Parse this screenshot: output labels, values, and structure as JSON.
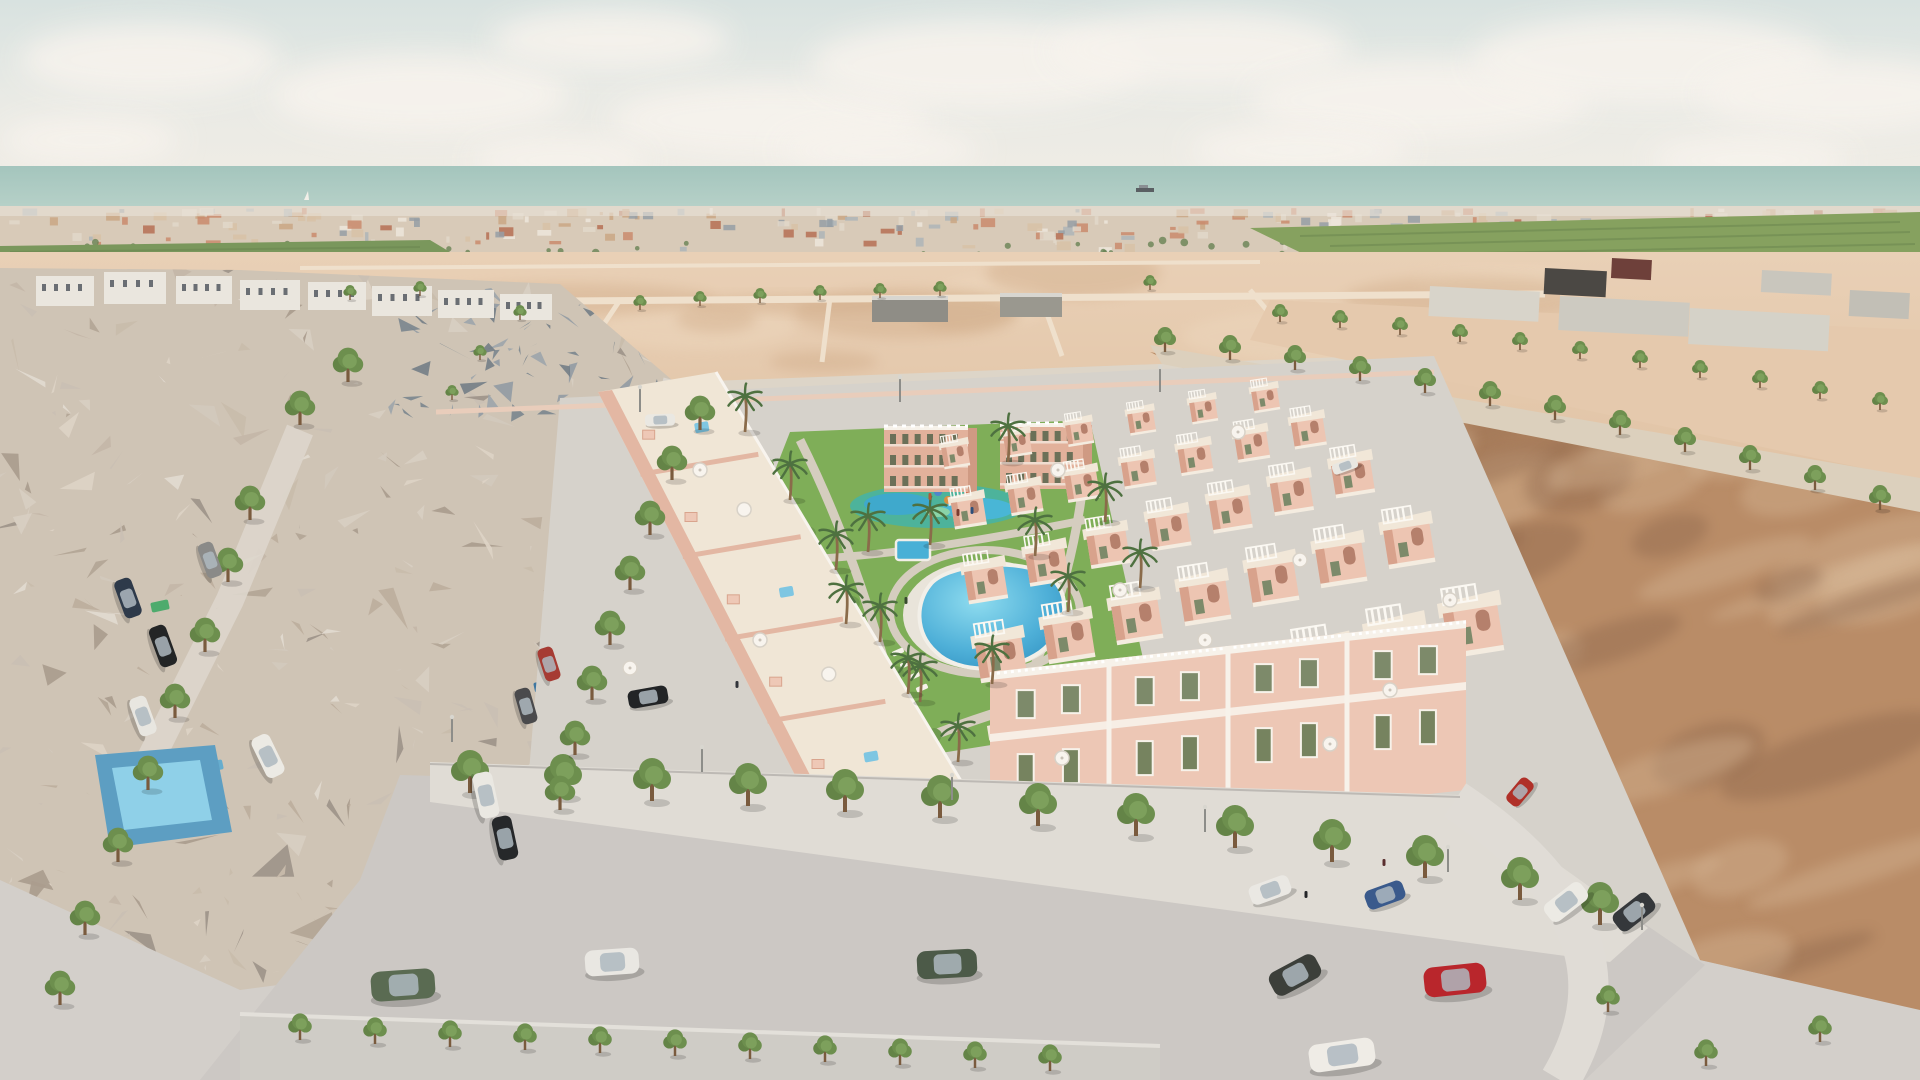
{
  "meta": {
    "description": "Aerial 3D architectural render of a new pink townhouse development with central pool park, between an existing low-poly neighborhood, desert plots and the sea on the horizon",
    "render_type": "architectural-visualization",
    "visible_text": ""
  },
  "colors": {
    "sky_top": "#d8e2e0",
    "sky_low": "#efece5",
    "cloud": "#f7f3ed",
    "sea_top": "#a4c5bd",
    "sea_low": "#bad3ca",
    "horizon_base": "#d8cab8",
    "orchard": "#7a975c",
    "field_green": "#86a15f",
    "sand_light": "#e9d0b6",
    "sand_dark": "#d9b795",
    "dirt": "#b98c67",
    "dirt_dark": "#8a6448",
    "dirt_light": "#d7b897",
    "mesh_base": "#cfc4b5",
    "pavement": "#d6d2cb",
    "street": "#ccc8c4",
    "sidewalk": "#e0dcd5",
    "lawn": "#7fae58",
    "path": "#d4ccbe",
    "pool_light": "#7fd2e8",
    "pool_deep": "#2f8fc0",
    "splash_green": "#4db39b",
    "house_wall": "#edc7b5",
    "house_shadow": "#d9a48d",
    "roof_cream": "#f0e6d6",
    "white_trim": "#f7f2ea",
    "apt_wall": "#e2b19b",
    "window_green": "#7d8a6a",
    "tree_green": "#6d8f4e",
    "palm_green": "#4e7140",
    "trunk": "#7a5b3e"
  },
  "scene": {
    "clouds": [
      [
        150,
        60,
        130,
        36
      ],
      [
        420,
        95,
        150,
        40
      ],
      [
        610,
        40,
        120,
        30
      ],
      [
        770,
        120,
        160,
        36
      ],
      [
        980,
        65,
        170,
        44
      ],
      [
        1200,
        50,
        150,
        38
      ],
      [
        1420,
        100,
        170,
        40
      ],
      [
        1650,
        60,
        180,
        44
      ],
      [
        1840,
        95,
        140,
        36
      ],
      [
        90,
        140,
        90,
        24
      ],
      [
        1300,
        150,
        110,
        26
      ],
      [
        560,
        160,
        90,
        22
      ],
      [
        1750,
        160,
        100,
        24
      ],
      [
        880,
        150,
        100,
        22
      ]
    ],
    "boats": {
      "sailboat": [
        306,
        196
      ],
      "cargo": [
        1143,
        190
      ]
    },
    "horizon": {
      "seed": 7,
      "count": 240,
      "palette": [
        "#b3664a",
        "#c88465",
        "#e3d9cb",
        "#f0e9df",
        "#a9b3b9",
        "#8f9aa3",
        "#d8c1a4",
        "#c9a37f"
      ]
    },
    "mesh": {
      "seed": 13,
      "count": 260,
      "palette": [
        "#ddd3c6",
        "#c9bcab",
        "#bdae9d",
        "#b3a596",
        "#d3c9bd",
        "#c4b6a8",
        "#aa9c8e",
        "#e2dad0",
        "#9e948a",
        "#cabfb4",
        "#d8cec2"
      ],
      "dark_count": 70,
      "dark_palette": [
        "#8e99a2",
        "#76828c",
        "#9aa3aa",
        "#6e7a84"
      ]
    },
    "condos": [
      [
        36,
        276,
        58,
        30
      ],
      [
        104,
        272,
        62,
        32
      ],
      [
        176,
        276,
        56,
        28
      ],
      [
        240,
        280,
        60,
        30
      ],
      [
        308,
        282,
        58,
        28
      ],
      [
        372,
        286,
        60,
        30
      ],
      [
        438,
        290,
        56,
        28
      ],
      [
        500,
        294,
        52,
        26
      ]
    ],
    "mesh_pools": [
      [
        640,
        468,
        "#2e9e8f"
      ],
      [
        600,
        508,
        "#2e6f9e"
      ],
      [
        585,
        556,
        "#3b79a8"
      ],
      [
        568,
        602,
        "#2e6f9e"
      ],
      [
        556,
        642,
        "#35749f"
      ],
      [
        543,
        686,
        "#2e6f9e"
      ],
      [
        214,
        766,
        "#5aabd0"
      ],
      [
        160,
        606,
        "#3fa965"
      ]
    ],
    "warehouses": [
      [
        872,
        296,
        76,
        26,
        "#8f8d86"
      ],
      [
        1000,
        293,
        62,
        24,
        "#9a988f"
      ]
    ],
    "industrial": [
      [
        1430,
        286,
        110,
        30,
        "#d8d4ca"
      ],
      [
        1560,
        296,
        130,
        34,
        "#cdcac1"
      ],
      [
        1690,
        308,
        140,
        36,
        "#d5d2c8"
      ],
      [
        1545,
        268,
        62,
        26,
        "#4b4844"
      ],
      [
        1612,
        258,
        40,
        20,
        "#6e403a"
      ],
      [
        1762,
        270,
        70,
        22,
        "#c9c6bd"
      ],
      [
        1850,
        290,
        60,
        26,
        "#c2bfb6"
      ]
    ],
    "left_block": {
      "x1": 598,
      "y1": 392,
      "x2": 852,
      "y2": 886,
      "ox": 118,
      "oy": -20,
      "n": 6
    },
    "apartments": [
      {
        "x": 884,
        "y": 426,
        "w": 84,
        "h": 66
      },
      {
        "x": 1000,
        "y": 423,
        "w": 83,
        "h": 66
      }
    ],
    "right_rows": [
      {
        "x1": 955,
        "y1": 452,
        "x2": 1265,
        "y2": 396,
        "n": 6,
        "s": 0.5
      },
      {
        "x1": 968,
        "y1": 508,
        "x2": 1308,
        "y2": 428,
        "n": 7,
        "s": 0.62
      },
      {
        "x1": 985,
        "y1": 578,
        "x2": 1352,
        "y2": 472,
        "n": 7,
        "s": 0.76
      },
      {
        "x1": 1000,
        "y1": 652,
        "x2": 1408,
        "y2": 538,
        "n": 7,
        "s": 0.9
      },
      {
        "x1": 1022,
        "y1": 744,
        "x2": 1472,
        "y2": 622,
        "n": 7,
        "s": 1.06
      }
    ],
    "front_row": {
      "x1": 990,
      "y1": 672,
      "x2": 1466,
      "y2": 620,
      "h": 170,
      "n": 4
    },
    "planters": [
      [
        762,
        472
      ],
      [
        804,
        540
      ],
      [
        848,
        610
      ],
      [
        892,
        680
      ],
      [
        930,
        742
      ]
    ],
    "palms": [
      [
        745,
        432
      ],
      [
        790,
        500
      ],
      [
        836,
        570
      ],
      [
        880,
        642
      ],
      [
        920,
        702
      ],
      [
        958,
        762
      ],
      [
        868,
        552
      ],
      [
        1035,
        556
      ],
      [
        1068,
        612
      ],
      [
        992,
        684
      ],
      [
        908,
        694
      ],
      [
        846,
        624
      ],
      [
        1105,
        522
      ],
      [
        1140,
        588
      ],
      [
        1008,
        462
      ],
      [
        930,
        545
      ]
    ],
    "loungers": [
      [
        898,
        652
      ],
      [
        906,
        664
      ],
      [
        914,
        676
      ],
      [
        922,
        688
      ],
      [
        890,
        676
      ],
      [
        882,
        664
      ]
    ],
    "trees": {
      "street": [
        [
          470,
          793
        ],
        [
          563,
          797
        ],
        [
          652,
          801
        ],
        [
          748,
          806
        ],
        [
          845,
          812
        ],
        [
          940,
          818
        ],
        [
          1038,
          826
        ],
        [
          1136,
          836
        ],
        [
          1235,
          848
        ],
        [
          1332,
          862
        ],
        [
          1425,
          878
        ],
        [
          1520,
          900
        ],
        [
          1600,
          925
        ]
      ],
      "median": [
        [
          300,
          1040
        ],
        [
          375,
          1044
        ],
        [
          450,
          1047
        ],
        [
          525,
          1050
        ],
        [
          600,
          1053
        ],
        [
          675,
          1056
        ],
        [
          750,
          1059
        ],
        [
          825,
          1062
        ],
        [
          900,
          1065
        ],
        [
          975,
          1068
        ],
        [
          1050,
          1071
        ],
        [
          1608,
          1012
        ],
        [
          1706,
          1066
        ],
        [
          1820,
          1042
        ]
      ],
      "left": [
        [
          348,
          382
        ],
        [
          300,
          425
        ],
        [
          250,
          520
        ],
        [
          228,
          582
        ],
        [
          205,
          652
        ],
        [
          175,
          718
        ],
        [
          148,
          790
        ],
        [
          118,
          862
        ],
        [
          85,
          935
        ],
        [
          60,
          1005
        ],
        [
          700,
          430
        ],
        [
          672,
          480
        ],
        [
          650,
          535
        ],
        [
          630,
          590
        ],
        [
          610,
          645
        ],
        [
          592,
          700
        ],
        [
          575,
          755
        ],
        [
          560,
          810
        ]
      ],
      "avenue": [
        [
          1165,
          352
        ],
        [
          1230,
          360
        ],
        [
          1295,
          370
        ],
        [
          1360,
          381
        ],
        [
          1425,
          393
        ],
        [
          1490,
          406
        ],
        [
          1555,
          420
        ],
        [
          1620,
          435
        ],
        [
          1685,
          452
        ],
        [
          1750,
          470
        ],
        [
          1815,
          490
        ],
        [
          1880,
          510
        ]
      ],
      "avenue_far": [
        [
          1280,
          322
        ],
        [
          1340,
          328
        ],
        [
          1400,
          335
        ],
        [
          1460,
          342
        ],
        [
          1520,
          350
        ],
        [
          1580,
          359
        ],
        [
          1640,
          368
        ],
        [
          1700,
          378
        ],
        [
          1760,
          388
        ],
        [
          1820,
          399
        ],
        [
          1880,
          410
        ]
      ],
      "desert": [
        [
          640,
          310
        ],
        [
          700,
          306
        ],
        [
          760,
          303
        ],
        [
          820,
          300
        ],
        [
          880,
          298
        ],
        [
          940,
          296
        ],
        [
          1150,
          290
        ],
        [
          520,
          320
        ],
        [
          480,
          360
        ],
        [
          452,
          400
        ],
        [
          350,
          300
        ],
        [
          420,
          296
        ]
      ]
    },
    "cars": [
      {
        "name": "green-suv",
        "x": 403,
        "y": 985,
        "w": 64,
        "h": 30,
        "r": -4,
        "c": "#5a6b52"
      },
      {
        "name": "white-suv",
        "x": 612,
        "y": 962,
        "w": 54,
        "h": 26,
        "r": -4,
        "c": "#e9e7e2"
      },
      {
        "name": "darkgreen-suv",
        "x": 947,
        "y": 964,
        "w": 60,
        "h": 28,
        "r": -3,
        "c": "#4c5a48"
      },
      {
        "name": "dark-suv",
        "x": 1295,
        "y": 975,
        "w": 52,
        "h": 26,
        "r": -28,
        "c": "#3c3f3a"
      },
      {
        "name": "red-hatchback",
        "x": 1455,
        "y": 980,
        "w": 62,
        "h": 30,
        "r": -6,
        "c": "#b9262c"
      },
      {
        "name": "white-coupe",
        "x": 1342,
        "y": 1055,
        "w": 66,
        "h": 28,
        "r": -8,
        "c": "#efece6"
      },
      {
        "name": "white-sportscar",
        "x": 1566,
        "y": 902,
        "w": 46,
        "h": 22,
        "r": -38,
        "c": "#eceae4"
      },
      {
        "name": "dark-sedan",
        "x": 1634,
        "y": 912,
        "w": 44,
        "h": 22,
        "r": -38,
        "c": "#35383b"
      },
      {
        "name": "red-car",
        "x": 1520,
        "y": 792,
        "w": 30,
        "h": 16,
        "r": -50,
        "c": "#b03028"
      },
      {
        "name": "white-pickup",
        "x": 486,
        "y": 795,
        "w": 46,
        "h": 20,
        "r": 78,
        "c": "#eae8e2"
      },
      {
        "name": "black-suv",
        "x": 505,
        "y": 838,
        "w": 44,
        "h": 20,
        "r": 78,
        "c": "#26282a"
      },
      {
        "name": "red-compact",
        "x": 549,
        "y": 664,
        "w": 34,
        "h": 16,
        "r": 72,
        "c": "#a63b33"
      },
      {
        "name": "gray-sedan",
        "x": 526,
        "y": 706,
        "w": 36,
        "h": 16,
        "r": 74,
        "c": "#4a4a4c"
      },
      {
        "name": "navy-car",
        "x": 128,
        "y": 598,
        "w": 40,
        "h": 18,
        "r": 70,
        "c": "#2e3a4a"
      },
      {
        "name": "black-car",
        "x": 163,
        "y": 646,
        "w": 42,
        "h": 18,
        "r": 70,
        "c": "#232526"
      },
      {
        "name": "white-car",
        "x": 143,
        "y": 716,
        "w": 40,
        "h": 18,
        "r": 70,
        "c": "#e8e6e0"
      },
      {
        "name": "white-van",
        "x": 268,
        "y": 756,
        "w": 44,
        "h": 20,
        "r": 64,
        "c": "#eceae4"
      },
      {
        "name": "white-car-road",
        "x": 660,
        "y": 420,
        "w": 30,
        "h": 12,
        "r": -2,
        "c": "#eae8e2"
      },
      {
        "name": "white-car-avenue",
        "x": 1345,
        "y": 466,
        "w": 26,
        "h": 11,
        "r": -20,
        "c": "#e9e7e1"
      },
      {
        "name": "white-drive-car",
        "x": 1270,
        "y": 890,
        "w": 42,
        "h": 20,
        "r": -20,
        "c": "#eae8e3"
      },
      {
        "name": "blue-drive-car",
        "x": 1385,
        "y": 895,
        "w": 40,
        "h": 20,
        "r": -20,
        "c": "#3a5a8c"
      },
      {
        "name": "black-convertible",
        "x": 648,
        "y": 697,
        "w": 40,
        "h": 18,
        "r": -10,
        "c": "#222426"
      },
      {
        "name": "gray-car-mesh",
        "x": 210,
        "y": 560,
        "w": 36,
        "h": 16,
        "r": 70,
        "c": "#8a8a88"
      }
    ],
    "umbrellas": [
      [
        630,
        668
      ],
      [
        700,
        470
      ],
      [
        760,
        640
      ],
      [
        1058,
        470
      ],
      [
        1120,
        590
      ],
      [
        1205,
        640
      ],
      [
        1300,
        560
      ],
      [
        1390,
        690
      ],
      [
        1450,
        600
      ],
      [
        1238,
        432
      ],
      [
        1062,
        758
      ],
      [
        1330,
        744
      ]
    ],
    "figures": [
      [
        737,
        688,
        "#31343a"
      ],
      [
        958,
        516,
        "#7a3b30"
      ],
      [
        972,
        514,
        "#2e4f7a"
      ],
      [
        906,
        604,
        "#384a2e"
      ],
      [
        1306,
        898,
        "#232528"
      ],
      [
        1384,
        866,
        "#5a2e2e"
      ],
      [
        930,
        500,
        "#b05a38"
      ]
    ],
    "lamps": [
      [
        452,
        742
      ],
      [
        702,
        772
      ],
      [
        952,
        800
      ],
      [
        1205,
        832
      ],
      [
        1448,
        872
      ],
      [
        1642,
        930
      ],
      [
        640,
        412
      ],
      [
        900,
        402
      ],
      [
        1160,
        392
      ]
    ],
    "playground": [
      [
        948,
        500,
        "#d98f3f"
      ],
      [
        968,
        494,
        "#cf6f4f"
      ],
      [
        938,
        492,
        "#4f86c9"
      ],
      [
        958,
        508,
        "#3f77c9"
      ]
    ]
  }
}
